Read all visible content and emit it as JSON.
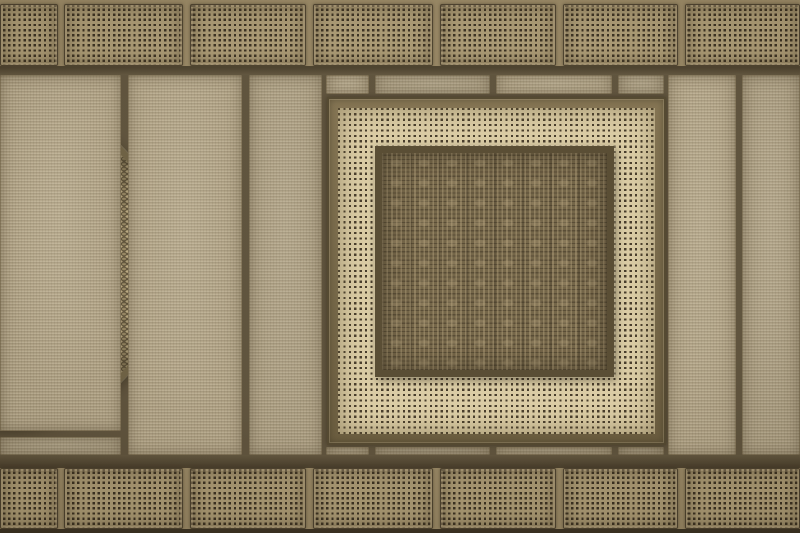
{
  "scene": {
    "description": "Decorative woven-material composition: borders of perforated cane panels, a band of textured planks, a woven circular medallion on the left, and a central framed square of cane webbing holding a dark brocade-weave panel",
    "materials": [
      "perforated cane panel",
      "woven plank",
      "cane webbing",
      "brocade weave",
      "woven medallion"
    ]
  },
  "palette": {
    "mortar": "#93825f",
    "band_dark": "#453a27",
    "band_dark2": "#5b4f38",
    "bottom_line": "#342b1c",
    "panel_bg": "#a6956f",
    "panel_dot": "#33291a",
    "panel_edge": "#453a27",
    "plank_base": "#b3a588",
    "seam": "#584c36",
    "webbing_bg": "#d9caa2",
    "webbing_dot": "#3f3423",
    "frame_light": "#7f6f4d",
    "frame_dark": "#655739",
    "frame_edge": "#4c4129",
    "inner_border": "#51452c",
    "weave_base": "#6d5e41",
    "circle_base": "#5e5138",
    "circle_light": "#b7a67e",
    "circle_mid": "#93835f",
    "circle_rim": "#675a3d"
  },
  "layout": {
    "width": 800,
    "height": 533,
    "top_row": {
      "y": 4,
      "h": 62,
      "panels": [
        {
          "x": 0,
          "w": 58
        },
        {
          "x": 64,
          "w": 119
        },
        {
          "x": 190,
          "w": 116
        },
        {
          "x": 313,
          "w": 120
        },
        {
          "x": 440,
          "w": 116
        },
        {
          "x": 563,
          "w": 115
        },
        {
          "x": 685,
          "w": 115
        }
      ]
    },
    "bottom_row": {
      "y": 468,
      "h": 61,
      "panels": [
        {
          "x": 0,
          "w": 58
        },
        {
          "x": 64,
          "w": 119
        },
        {
          "x": 190,
          "w": 116
        },
        {
          "x": 313,
          "w": 120
        },
        {
          "x": 440,
          "w": 116
        },
        {
          "x": 563,
          "w": 115
        },
        {
          "x": 685,
          "w": 115
        }
      ]
    },
    "band_top": {
      "y": 66,
      "h": 9
    },
    "band_bottom": {
      "y": 455,
      "h": 13
    },
    "bottom_edge": {
      "y": 529,
      "h": 4
    },
    "middle": {
      "y": 75,
      "h": 380,
      "planks": [
        {
          "x": 0,
          "w": 121,
          "y": 0,
          "h": 356
        },
        {
          "x": 0,
          "w": 121,
          "y": 362,
          "h": 18
        },
        {
          "x": 128,
          "w": 114,
          "y": 0,
          "h": 380
        },
        {
          "x": 249,
          "w": 73,
          "y": 0,
          "h": 380
        },
        {
          "x": 668,
          "w": 68,
          "y": 0,
          "h": 380
        },
        {
          "x": 742,
          "w": 58,
          "y": 0,
          "h": 380
        }
      ],
      "strip_top": {
        "y": 0,
        "h": 19,
        "segments": [
          {
            "x": 326,
            "w": 43
          },
          {
            "x": 375,
            "w": 115
          },
          {
            "x": 496,
            "w": 116
          },
          {
            "x": 618,
            "w": 46
          }
        ]
      },
      "strip_bottom": {
        "y": 372,
        "h": 8,
        "segments": [
          {
            "x": 326,
            "w": 43
          },
          {
            "x": 375,
            "w": 115
          },
          {
            "x": 496,
            "w": 116
          },
          {
            "x": 618,
            "w": 46
          }
        ]
      }
    },
    "circle": {
      "cx": 4,
      "cy": 189,
      "r": 166,
      "rim": 6
    },
    "square": {
      "x": 327,
      "y": 22,
      "w": 339,
      "h": 348,
      "band": 9,
      "inner": {
        "x": 37,
        "y": 38,
        "w": 239,
        "h": 231,
        "border": 7
      }
    }
  }
}
